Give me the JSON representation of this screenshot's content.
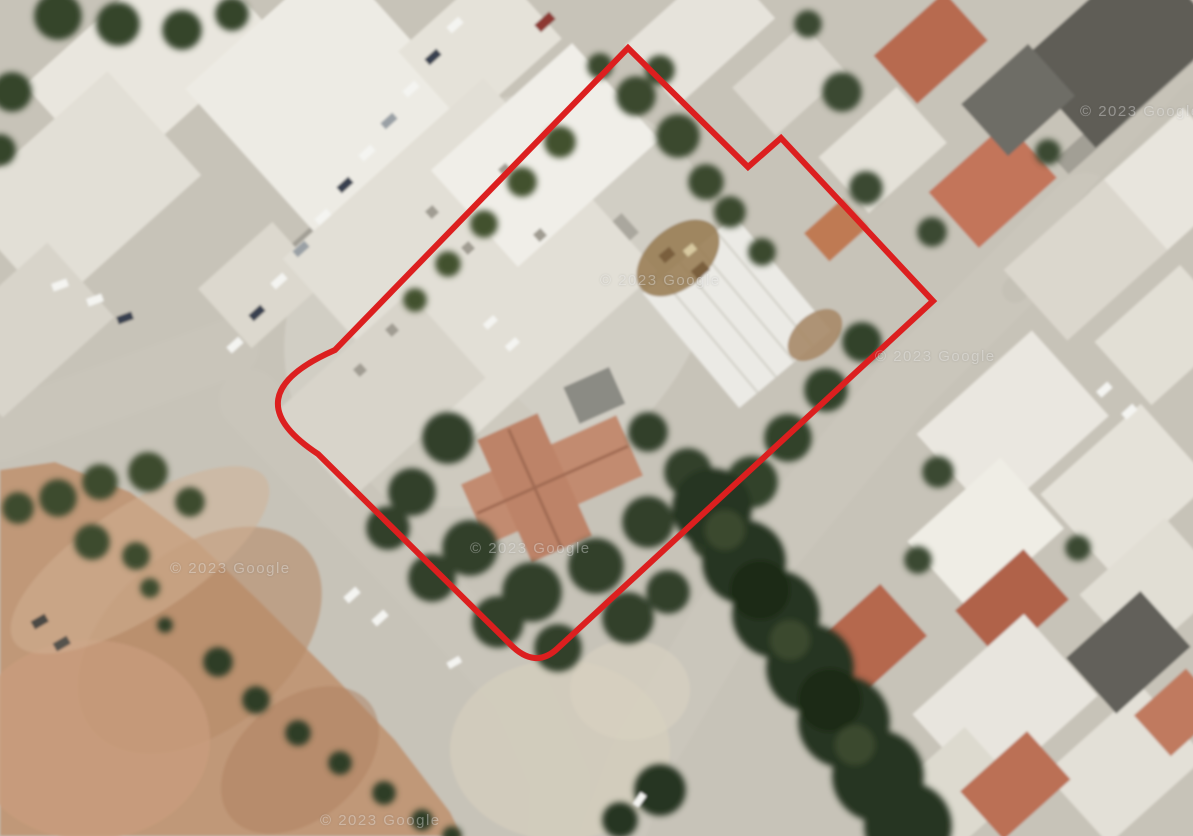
{
  "meta": {
    "view_type": "satellite-aerial-imagery",
    "description": "Aerial satellite view of an urban block with a red plot boundary outline drawn around a property containing warehouses, a red-roofed house and dense trees; dirt field at lower left, roads and buildings around"
  },
  "watermarks": {
    "text": "© 2023 Google"
  },
  "boundary": {
    "color": "#dc1f1f",
    "stroke_width": 6,
    "path_d": "M 628 48 L 748 167 L 781 138 L 933 301 L 558 648 Q 535 670 510 644 L 318 454 Q 230 396 335 350 Z",
    "vertices": [
      {
        "x": 628,
        "y": 48
      },
      {
        "x": 748,
        "y": 167
      },
      {
        "x": 781,
        "y": 138
      },
      {
        "x": 933,
        "y": 301
      },
      {
        "x": 535,
        "y": 665
      },
      {
        "x": 273,
        "y": 410
      }
    ]
  },
  "palette": {
    "road": "#c7c3b8",
    "building_light": "#eceae3",
    "field_dirt": "#c09878",
    "trees_dark": "#2c3a24",
    "roof_red": "#b5674d",
    "roof_salmon_house": "#c28b70",
    "roof_dark_gray": "#5e5d57"
  }
}
